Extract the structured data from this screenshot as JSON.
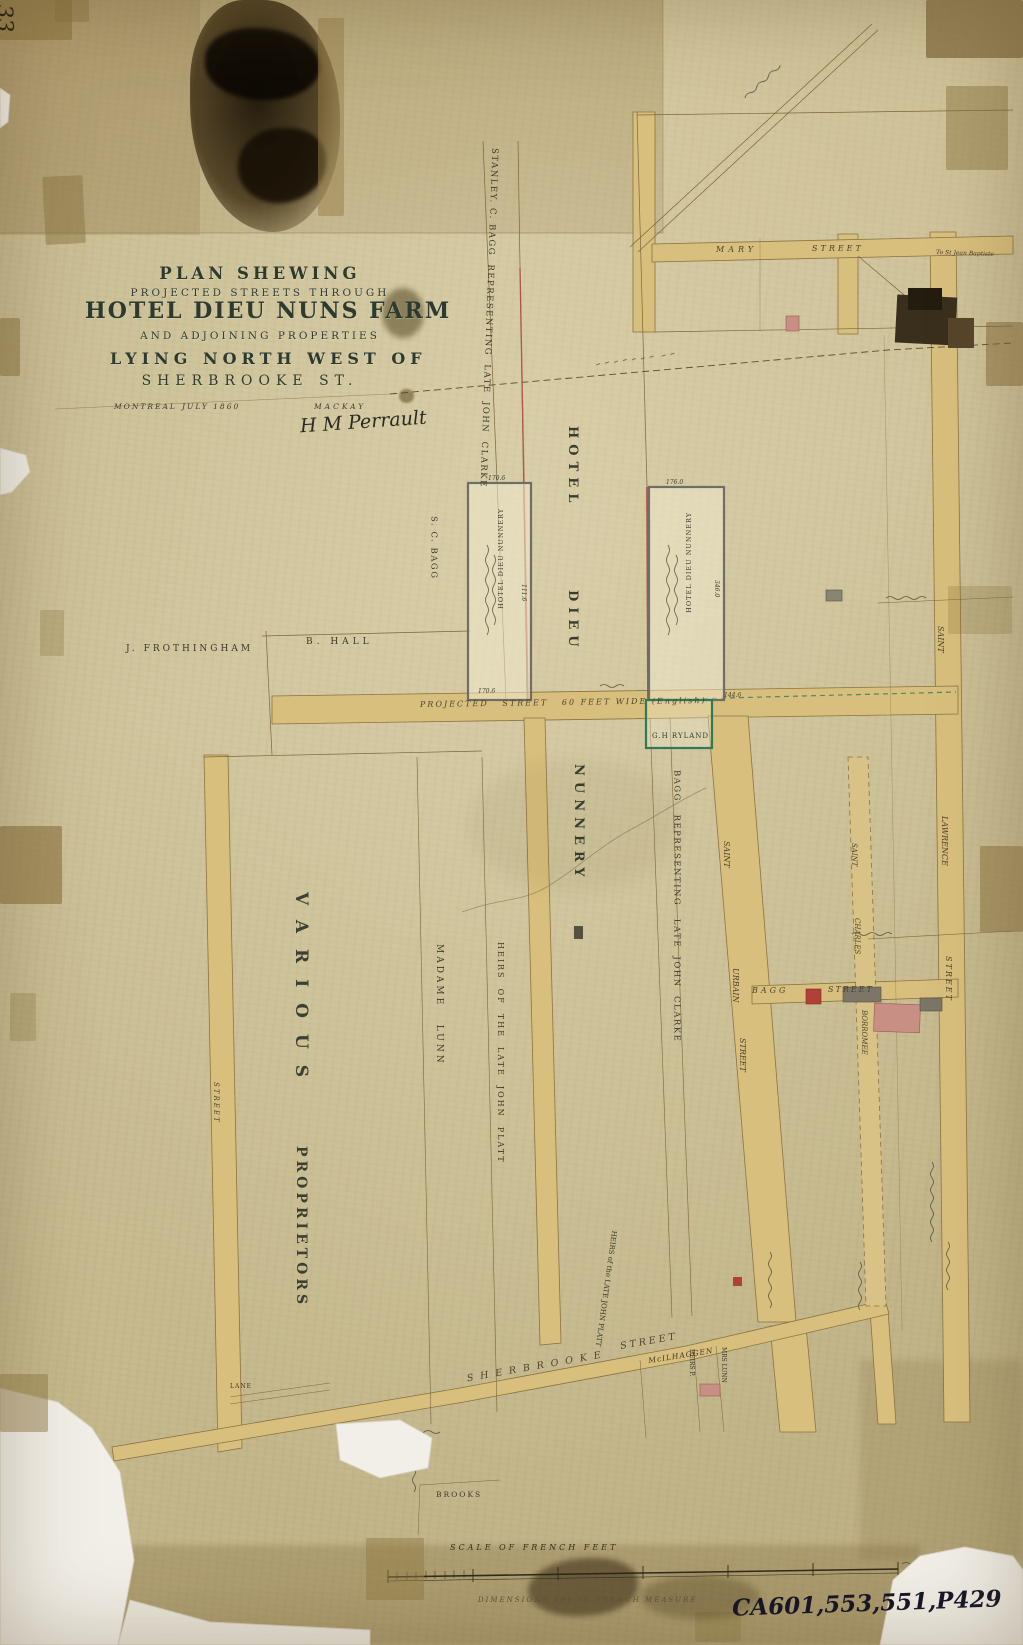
{
  "archive": {
    "corner_number": "33",
    "catalog_number": "CA601,553,551,P429"
  },
  "title_block": {
    "line1": "PLAN SHEWING",
    "line2": "PROJECTED STREETS THROUGH",
    "line3": "HOTEL DIEU NUNS FARM",
    "line4": "AND ADJOINING PROPERTIES",
    "line5": "LYING NORTH WEST OF",
    "line6": "SHERBROOKE ST.",
    "city": "MONTREAL",
    "date": "JULY 1860",
    "surveyor": "MACKAY",
    "signature": "H M Perrault"
  },
  "streets": {
    "mary_word1": "MARY",
    "mary_word2": "STREET",
    "projected": "PROJECTED   STREET   60 FEET WIDE (English)",
    "st_urbain": {
      "w1": "SAINT",
      "w2": "URBAIN",
      "w3": "STREET"
    },
    "st_charles": {
      "w1": "SAINT",
      "w2": "CHARLES",
      "w3": "BORROMEE"
    },
    "st_lawrence": {
      "w1": "SAINT",
      "w2": "LAWRENCE",
      "w3": "STREET"
    },
    "bagg_word1": "BAGG",
    "bagg_word2": "STREET",
    "sherbrooke_word1": "SHERBROOKE",
    "sherbrooke_word2": "STREET",
    "left_street": "STREET",
    "lane": "LANE"
  },
  "owners": {
    "stanley_bagg": "STANLEY. C. BAGG  REPRESENTING  LATE  JOHN  CLARKE",
    "sc_bagg": "S. C. BAGG",
    "b_hall": "B. HALL",
    "frothingham": "J. FROTHINGHAM",
    "hotel_dieu": {
      "w1": "HOTEL",
      "w2": "DIEU",
      "w3": "NUNNERY"
    },
    "bagg_clarke": "BAGG   REPRESENTING   LATE  JOHN  CLARKE",
    "various": {
      "w1": "VARIOUS",
      "w2": "PROPRIETORS"
    },
    "madame_lunn": "MADAME   LUNN",
    "heirs_platt": "HEIRS  OF  THE  LATE  JOHN  PLATT",
    "heirs_platt2": "HEIRS of the LATE JOHN PLATT",
    "gh_ryland": "G.H RYLAND",
    "brooks": "BROOKS",
    "mcilhaggen": "McILHAGGEN",
    "heirs_p": "HEIRS P.",
    "mrs_lunn": "MRS LUNN"
  },
  "parcels": {
    "box1_name": "HOTEL DIEU NUNNERY",
    "box1_dim_top": "170.6",
    "box1_dim_side": "111.6",
    "box1_dim_bottom": "170.6",
    "box2_name": "HOTEL DIEU NUNNERY",
    "box2_dim_top": "176.0",
    "box2_dim_side": "346.0",
    "box2_dim_bottom": "144.6"
  },
  "annotations": {
    "to_st_jean": "To St Jean Baptiste"
  },
  "scale_block": {
    "title": "SCALE OF FRENCH FEET",
    "note": "DIMENSIONS ARE IN FRENCH MEASURE"
  }
}
